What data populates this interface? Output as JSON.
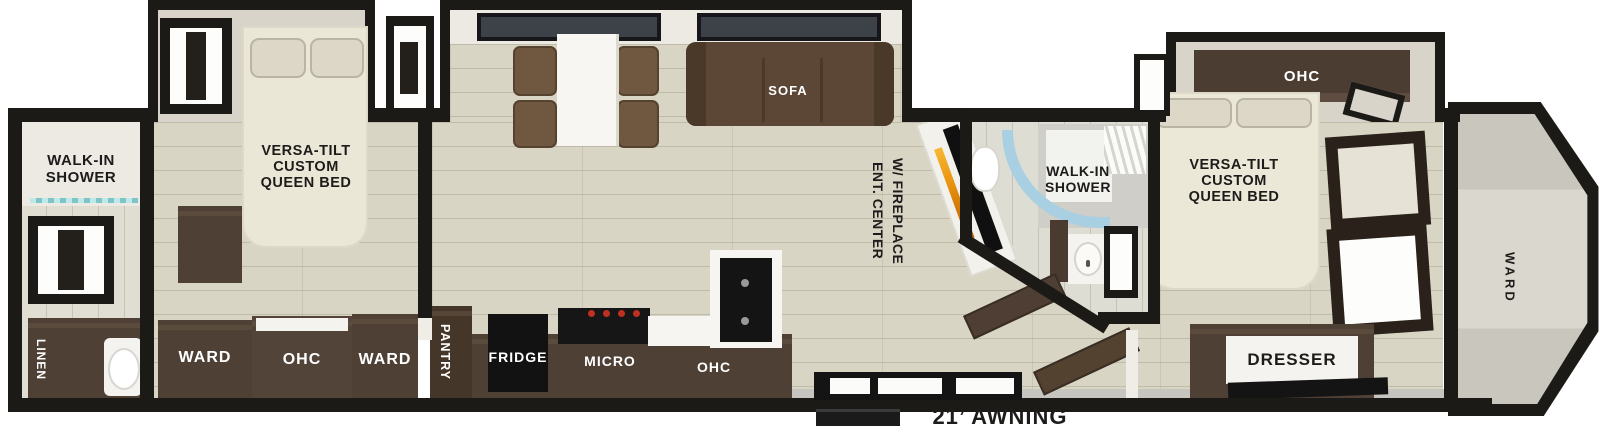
{
  "labels": {
    "rear_bath": {
      "shower_line1": "WALK-IN",
      "shower_line2": "SHOWER",
      "linen": "LINEN"
    },
    "rear_bedroom": {
      "bed_line1": "VERSA-TILT",
      "bed_line2": "CUSTOM",
      "bed_line3": "QUEEN BED",
      "ward_left": "WARD",
      "ohc": "OHC",
      "ward_right": "WARD"
    },
    "kitchen": {
      "pantry": "PANTRY",
      "fridge": "FRIDGE",
      "micro": "MICRO",
      "ohc": "OHC"
    },
    "living": {
      "sofa": "SOFA",
      "ent_line1": "ENT. CENTER",
      "ent_line2": "W/ FIREPLACE"
    },
    "mid_bath": {
      "shower_line1": "WALK-IN",
      "shower_line2": "SHOWER"
    },
    "front_bedroom": {
      "ohc": "OHC",
      "bed_line1": "VERSA-TILT",
      "bed_line2": "CUSTOM",
      "bed_line3": "QUEEN BED",
      "dresser": "DRESSER"
    },
    "front_cap": {
      "ward": "WARD"
    },
    "exterior": {
      "awning": "21’ AWNING"
    }
  },
  "colors": {
    "wall": "#1c1a17",
    "cabinet_dark": "#4f4035",
    "appliance_black": "#141414",
    "sofa_brown": "#5c4737",
    "bed_cream": "#ece8d8",
    "floor": "#d9d5c5",
    "shower_glass": "#a9cfe3",
    "fireplace_flame": "#e8920f",
    "cooktop_knob_red": "#c03022",
    "awning_gray": "#c7c5bf"
  }
}
